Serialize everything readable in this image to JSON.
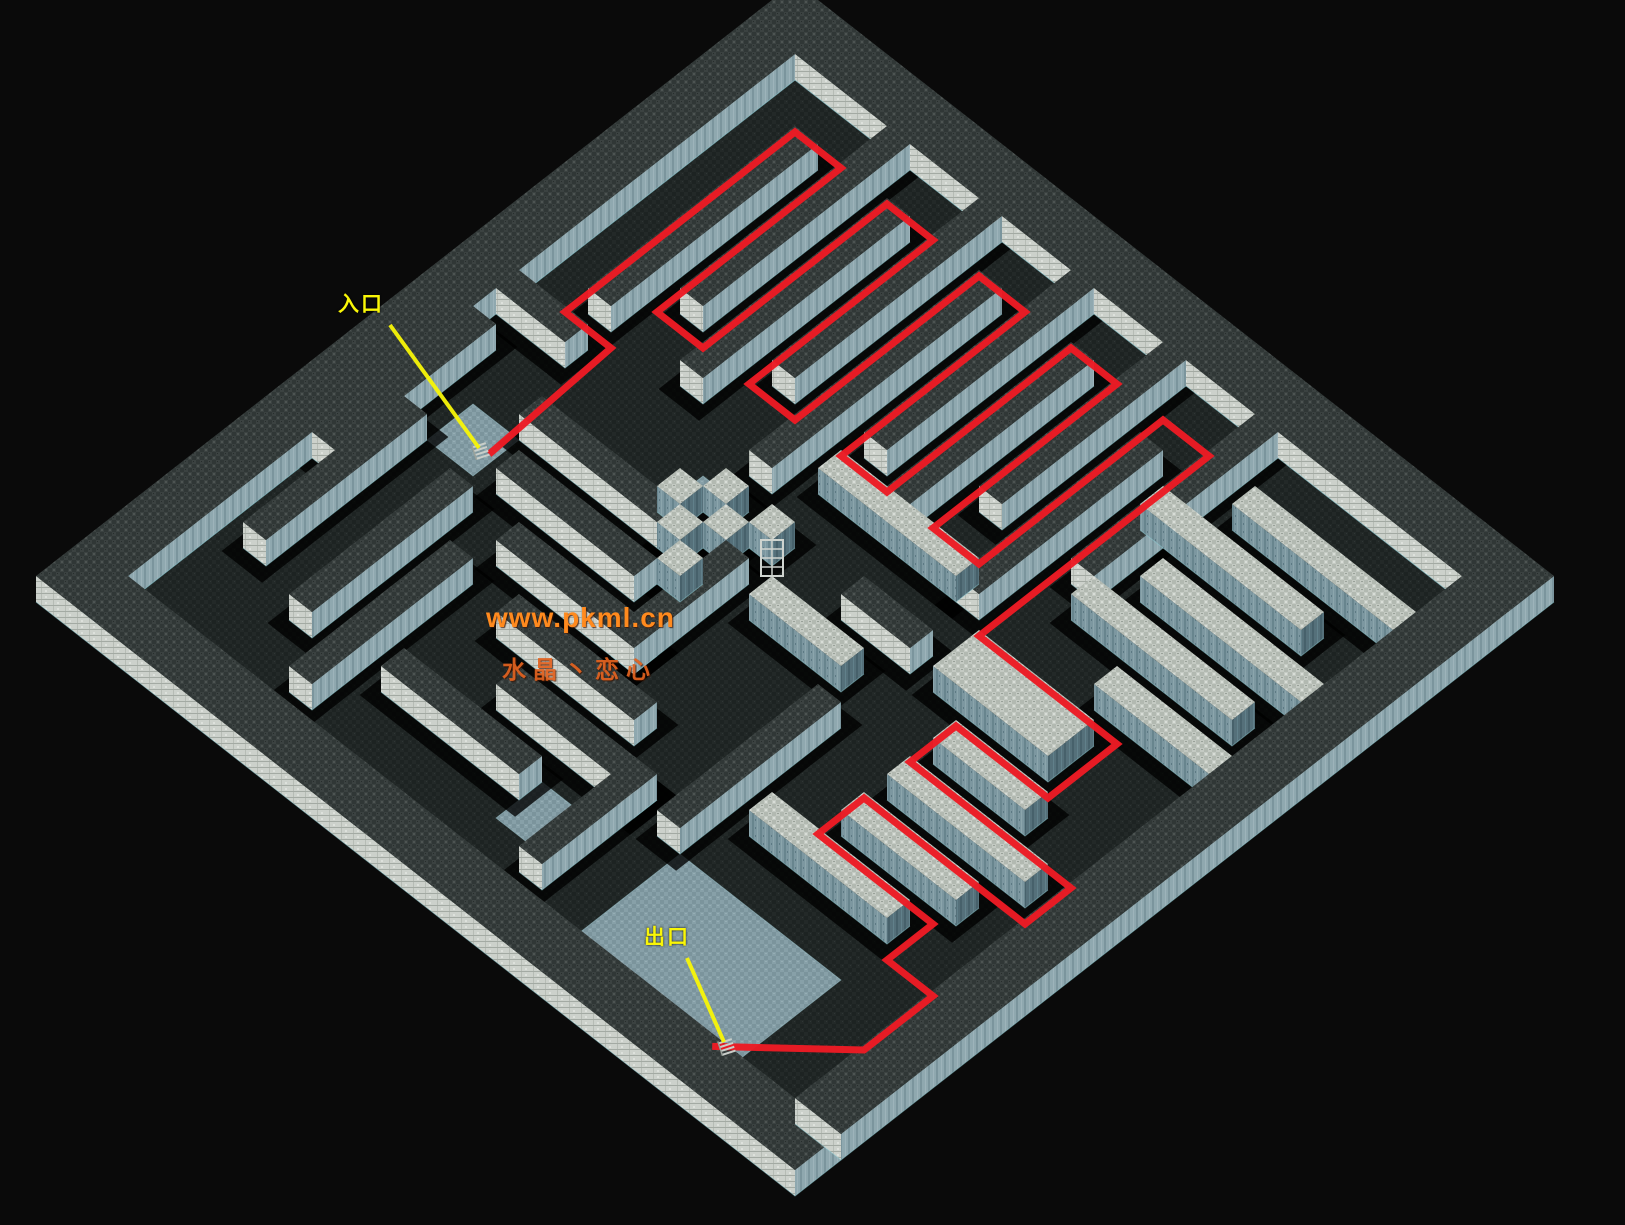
{
  "scene": {
    "width": 1625,
    "height": 1225,
    "background": "#0a0a0a",
    "title": "isometric maze map"
  },
  "iso": {
    "origin_x": 795,
    "origin_y": 8,
    "tile_w": 23,
    "tile_h": 18,
    "wall_h": 26,
    "grid": 33
  },
  "colors": {
    "path_red": "#ec1b24",
    "label_yellow": "#f9f607",
    "watermark_orange": "#ff8a1e",
    "watermark_orange2": "#e2621f",
    "stone_light": "#c4cac3",
    "stone_dark": "#3a4140",
    "face_light": "#ccd1cb",
    "face_teal": "#7c97a0",
    "face_teal_dark": "#55707a",
    "floor_dark": "#232928",
    "room_teal": "#87a0a8",
    "shadow": "#000000",
    "edge_cyan": "#8fd0d8"
  },
  "maze": {
    "borders": [
      [
        0,
        33,
        0,
        2,
        "d",
        0
      ],
      [
        0,
        2,
        2,
        33,
        "d",
        0
      ],
      [
        31,
        33,
        2,
        33,
        "d",
        2
      ],
      [
        2,
        31,
        31,
        33,
        "d",
        2
      ]
    ],
    "walls": [
      [
        4,
        13,
        4,
        5,
        "d"
      ],
      [
        2,
        11,
        6,
        7,
        "d"
      ],
      [
        4,
        13,
        8,
        9,
        "d"
      ],
      [
        2,
        11,
        10,
        11,
        "d"
      ],
      [
        4,
        14,
        12,
        13,
        "d"
      ],
      [
        2,
        11,
        14,
        15,
        "d"
      ],
      [
        4,
        12,
        16,
        17,
        "d"
      ],
      [
        2,
        10,
        18,
        19,
        "d"
      ],
      [
        5,
        13,
        20,
        21,
        "d"
      ],
      [
        2,
        10,
        22,
        23,
        "d"
      ],
      [
        4,
        5,
        24,
        31,
        "l"
      ],
      [
        6,
        7,
        22,
        29,
        "l"
      ],
      [
        8,
        9,
        24,
        31,
        "l"
      ],
      [
        10,
        11,
        23,
        30,
        "l"
      ],
      [
        12,
        13,
        26,
        31,
        "l"
      ],
      [
        14,
        16,
        22,
        27,
        "l"
      ],
      [
        12,
        13,
        14,
        20,
        "l"
      ],
      [
        15,
        16,
        18,
        21,
        "d"
      ],
      [
        17,
        18,
        16,
        20,
        "l"
      ],
      [
        17,
        22,
        14,
        15,
        "d"
      ],
      [
        14,
        15,
        2,
        5,
        "d"
      ],
      [
        16,
        23,
        2,
        3,
        "d"
      ],
      [
        17,
        18,
        6,
        12,
        "d"
      ],
      [
        20,
        27,
        3,
        4,
        "d"
      ],
      [
        19,
        20,
        7,
        13,
        "d"
      ],
      [
        21,
        28,
        6,
        7,
        "d"
      ],
      [
        21,
        22,
        9,
        15,
        "d"
      ],
      [
        23,
        30,
        8,
        9,
        "d"
      ],
      [
        23,
        24,
        11,
        17,
        "d"
      ],
      [
        25,
        26,
        13,
        19,
        "d"
      ],
      [
        27,
        28,
        10,
        16,
        "d"
      ],
      [
        25,
        30,
        18,
        19,
        "d"
      ],
      [
        17,
        18,
        24,
        28,
        "l"
      ],
      [
        19,
        20,
        24,
        30,
        "l"
      ],
      [
        21,
        22,
        24,
        29,
        "l"
      ],
      [
        23,
        24,
        22,
        28,
        "l"
      ],
      [
        19,
        26,
        20,
        21,
        "d"
      ]
    ],
    "pillars": [
      [
        15,
        16,
        12,
        13,
        "l"
      ],
      [
        16,
        17,
        13,
        14,
        "l"
      ],
      [
        15,
        16,
        14,
        15,
        "l"
      ],
      [
        17,
        18,
        12,
        13,
        "l"
      ],
      [
        18,
        19,
        13,
        14,
        "l"
      ],
      [
        16,
        17,
        11,
        12,
        "l"
      ]
    ],
    "rooms": [
      [
        26,
        31,
        21,
        28
      ],
      [
        18,
        20,
        4,
        6
      ],
      [
        15,
        17,
        11,
        13
      ],
      [
        27,
        29,
        16,
        19
      ]
    ]
  },
  "solution_path": {
    "color": "#ec1b24",
    "width": 7,
    "points": [
      [
        18.6,
        5.3
      ],
      [
        13,
        5
      ],
      [
        13,
        3
      ],
      [
        3,
        3
      ],
      [
        3,
        5
      ],
      [
        11,
        5
      ],
      [
        11,
        7
      ],
      [
        3,
        7
      ],
      [
        3,
        9
      ],
      [
        11,
        9
      ],
      [
        11,
        11
      ],
      [
        3,
        11
      ],
      [
        3,
        13
      ],
      [
        11,
        13
      ],
      [
        11,
        15
      ],
      [
        3,
        15
      ],
      [
        3,
        17
      ],
      [
        11,
        17
      ],
      [
        11,
        19
      ],
      [
        3,
        19
      ],
      [
        3,
        21
      ],
      [
        13,
        21
      ],
      [
        13,
        27
      ],
      [
        16,
        27
      ],
      [
        16,
        23
      ],
      [
        18,
        23
      ],
      [
        18,
        30
      ],
      [
        20,
        30
      ],
      [
        20,
        23
      ],
      [
        22,
        23
      ],
      [
        22,
        28
      ],
      [
        24,
        28
      ],
      [
        24,
        30
      ],
      [
        27,
        30
      ],
      [
        30.2,
        26.6
      ]
    ]
  },
  "markers": {
    "entrance": {
      "label": "入口",
      "line": [
        390,
        325,
        479,
        448
      ],
      "icon": [
        481,
        451
      ]
    },
    "exit": {
      "label": "出口",
      "line": [
        687,
        958,
        724,
        1042
      ],
      "icon": [
        727,
        1047
      ]
    },
    "gate_icon": [
      772,
      558
    ],
    "line_color": "#f8f608"
  },
  "watermark": {
    "line1": "www.pkml.cn",
    "line2": "水晶丶恋心"
  }
}
